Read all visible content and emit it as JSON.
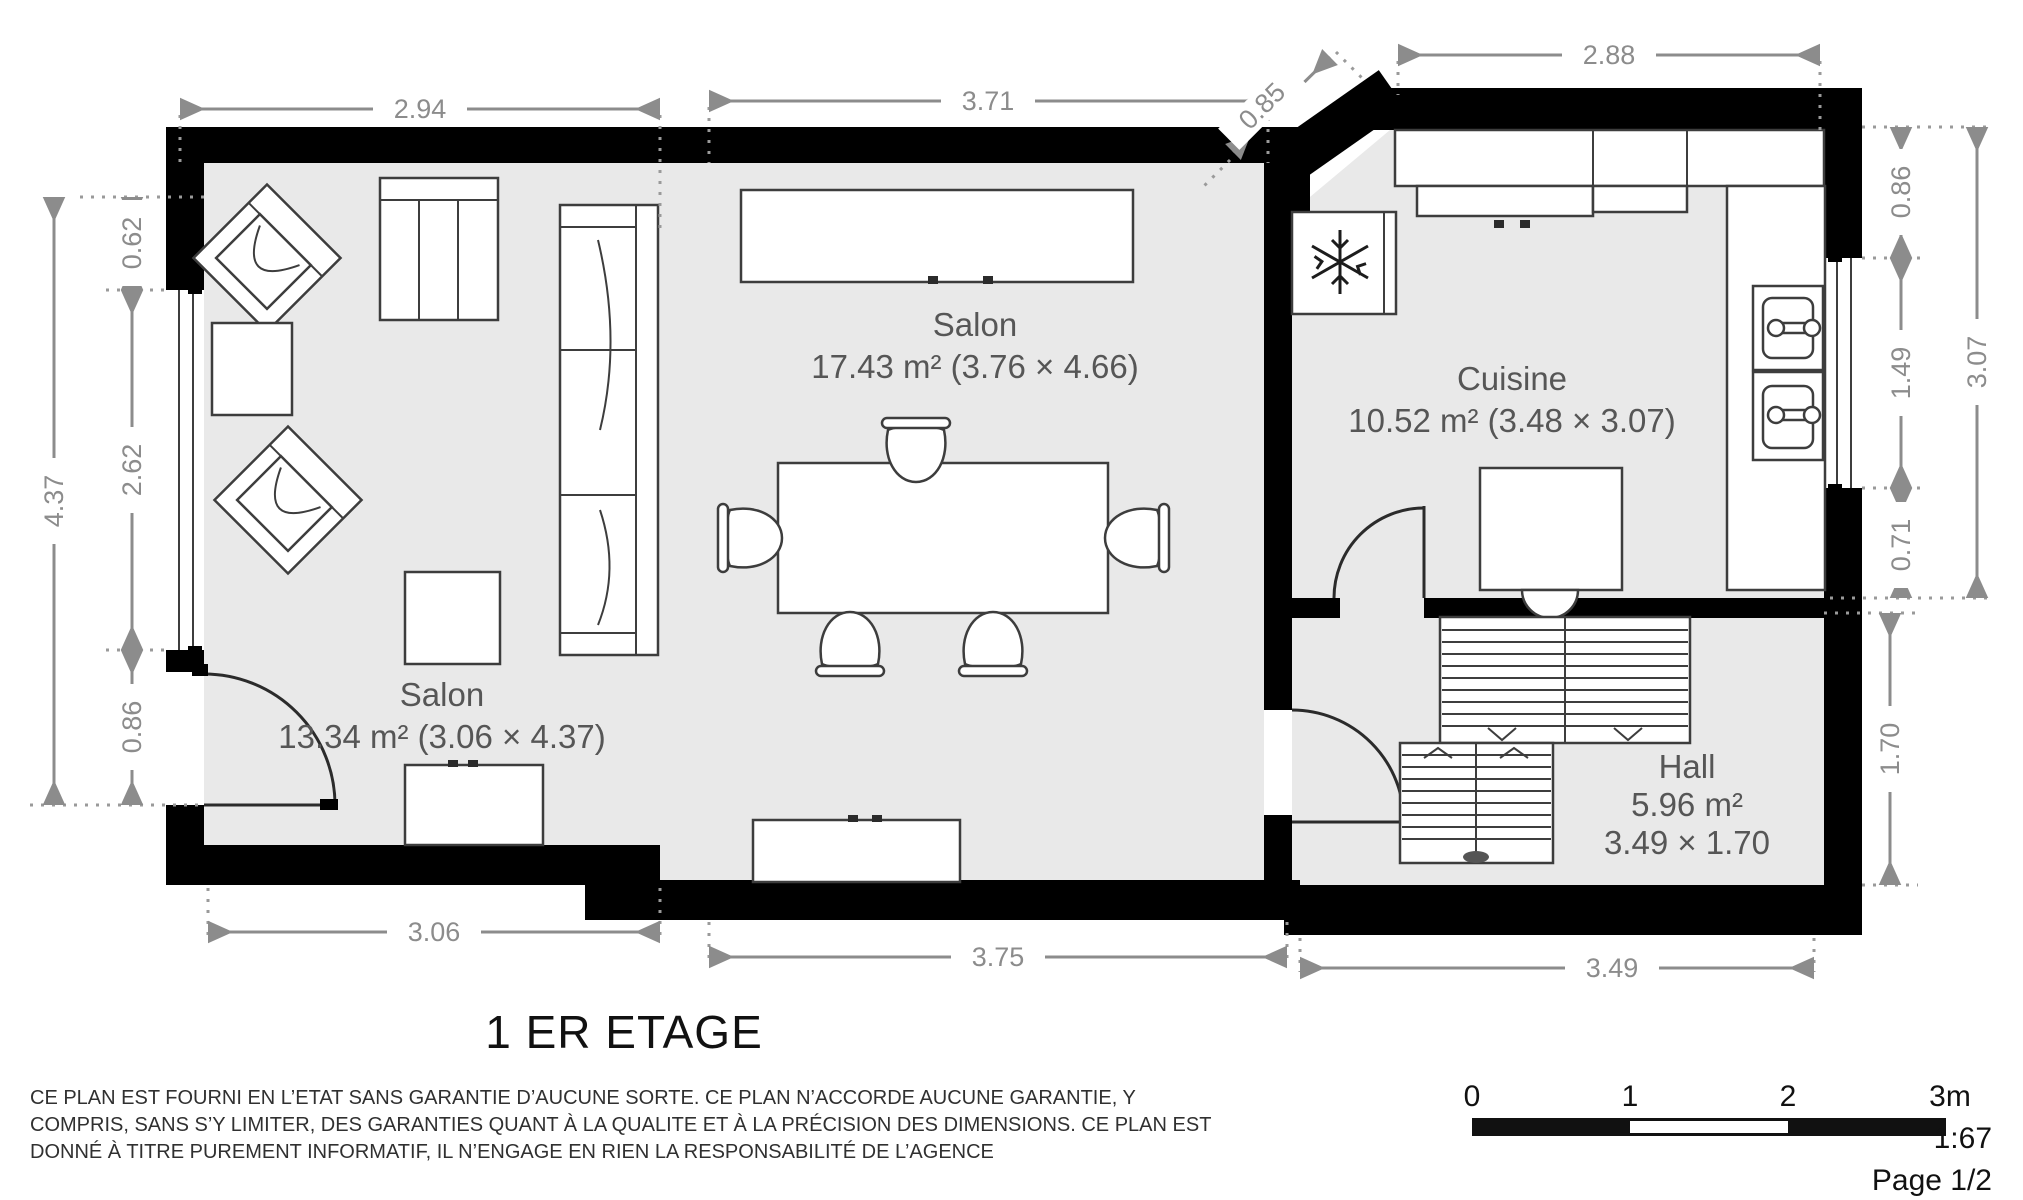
{
  "title": "1 ER ETAGE",
  "page_label": "Page 1/2",
  "scale": {
    "ticks": [
      "0",
      "1",
      "2",
      "3m"
    ],
    "ratio": "1:67"
  },
  "disclaimer": {
    "line1": "CE PLAN EST FOURNI EN L’ETAT SANS GARANTIE D’AUCUNE SORTE. CE PLAN N’ACCORDE AUCUNE GARANTIE, Y",
    "line2": "COMPRIS, SANS S’Y LIMITER, DES GARANTIES QUANT À LA QUALITE ET À LA PRÉCISION DES DIMENSIONS. CE PLAN EST",
    "line3": "DONNÉ À TITRE PUREMENT INFORMATIF, IL N’ENGAGE EN RIEN LA RESPONSABILITÉ DE L’AGENCE"
  },
  "rooms": {
    "salon_center": {
      "name": "Salon",
      "area": "17.43 m² (3.76 × 4.66)"
    },
    "salon_left": {
      "name": "Salon",
      "area": "13.34 m² (3.06 × 4.37)"
    },
    "cuisine": {
      "name": "Cuisine",
      "area": "10.52 m² (3.48 × 3.07)"
    },
    "hall": {
      "name": "Hall",
      "area": "5.96 m²",
      "dims": "3.49 × 1.70"
    }
  },
  "dims": {
    "top_salon_left": "2.94",
    "top_salon_center": "3.71",
    "diag": "0.85",
    "top_cuisine": "2.88",
    "left_outer": "4.37",
    "left_0": "0.62",
    "left_1": "2.62",
    "left_2": "0.86",
    "right_0": "0.86",
    "right_1": "1.49",
    "right_2": "0.71",
    "right_outer": "3.07",
    "right_hall": "1.70",
    "bottom_left": "3.06",
    "bottom_center": "3.75",
    "bottom_right": "3.49"
  }
}
